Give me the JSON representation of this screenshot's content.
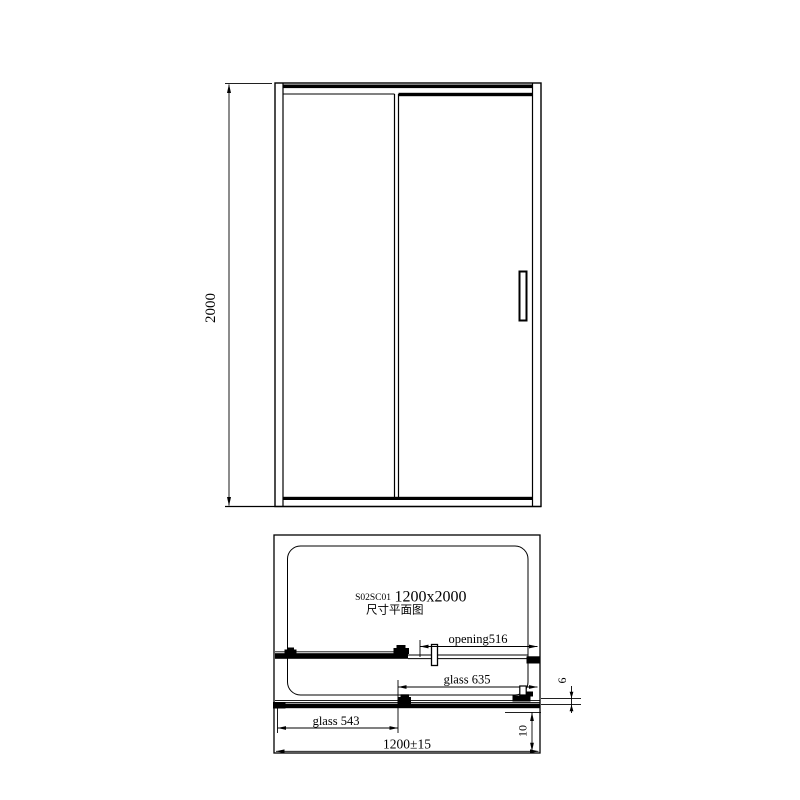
{
  "colors": {
    "line": "#000000",
    "background": "#ffffff"
  },
  "elevation": {
    "height_dim": "2000"
  },
  "plan": {
    "model_code": "S02SC01",
    "size": "1200x2000",
    "subtitle": "尺寸平面图",
    "opening": "opening516",
    "glass_right": "glass 635",
    "glass_left": "glass 543",
    "overall_width": "1200±15",
    "edge_offset": "10",
    "glass_thickness": "6"
  }
}
